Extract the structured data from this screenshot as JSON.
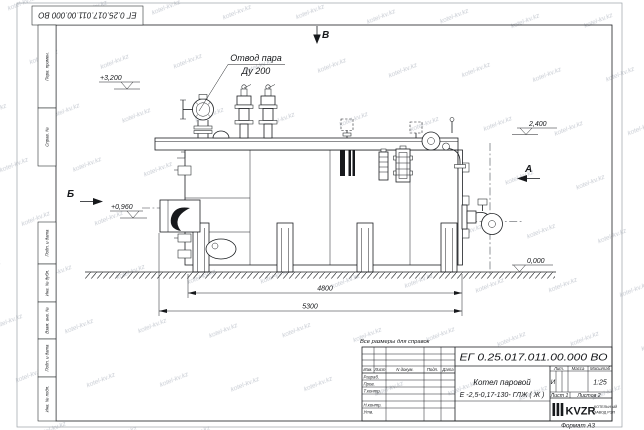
{
  "watermark": {
    "text": "kotel-kv.kz"
  },
  "stamps": {
    "designation_rotated": "ЕГ 0.25.017.011.00.000  ВО",
    "left_margin": [
      "Перв. примен.",
      "Справ. №",
      "Подп. и дата",
      "Инв. № дубл.",
      "Взам. инв. №",
      "Подп. и дата",
      "Инв. № подл."
    ]
  },
  "drawing": {
    "note": "Все размеры для справок",
    "labels": {
      "steam_outlet_line1": "Отвод пара",
      "steam_outlet_line2": "Ду 200"
    },
    "views": {
      "a": "А",
      "b": "Б",
      "v": "В"
    },
    "elevations": {
      "top": "+3,200",
      "right": "2,400",
      "burner": "+0,960",
      "ground": "0,000"
    },
    "dimensions": {
      "inner": "4800",
      "overall": "5300"
    }
  },
  "title_block": {
    "designation": "ЕГ 0.25.017.011.00.000  ВО",
    "product_name_line1": "Котел паровой",
    "product_name_line2": "Е -2,5-0,17-130- ГЛЖ ( Ж )",
    "header_cols": [
      "Изм.",
      "Лист",
      "N докум.",
      "Подп.",
      "Дата"
    ],
    "row_labels": [
      "Разраб.",
      "Пров.",
      "Т.контр.",
      "Н.контр.",
      "Утв."
    ],
    "lit_label": "Лит.",
    "mass_label": "Масса",
    "scale_label": "Масштаб",
    "lit_value": "И",
    "scale_value": "1:25",
    "sheet_label": "Лист 1",
    "sheets_label": "Листов 2",
    "company": {
      "logo": "KVZR",
      "tagline1": "КОТЕЛЬНЫЙ",
      "tagline2": "ЗАВОД РЭП"
    },
    "format_label": "Формат А3"
  }
}
